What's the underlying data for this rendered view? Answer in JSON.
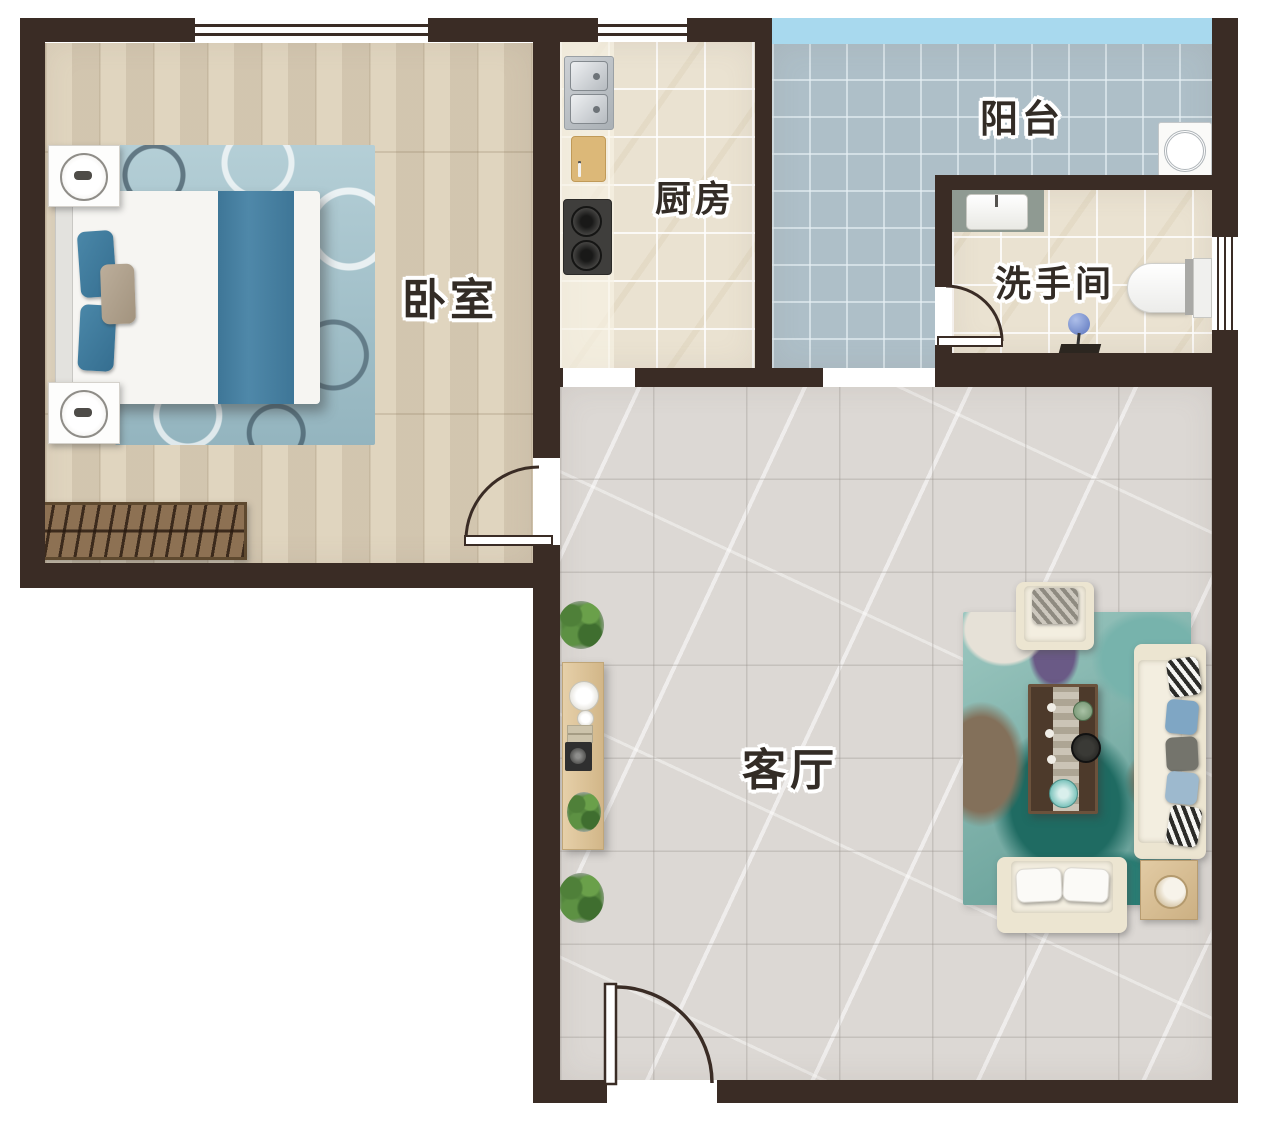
{
  "floorplan": {
    "type": "apartment-floor-plan",
    "rooms": [
      {
        "id": "bedroom",
        "label": "卧室"
      },
      {
        "id": "kitchen",
        "label": "厨房"
      },
      {
        "id": "balcony",
        "label": "阳台"
      },
      {
        "id": "bathroom",
        "label": "洗手间"
      },
      {
        "id": "living_room",
        "label": "客厅"
      }
    ],
    "colors": {
      "wall": "#3a2c25",
      "glass": "#a8d9ee",
      "bedroom_floor": "#ddd0b8",
      "kitchen_floor": "#eae2d1",
      "balcony_floor": "#aebfc8",
      "bathroom_floor": "#eae2d1",
      "living_floor": "#dcd8d4",
      "bedroom_rug": "#a7c6cf",
      "living_rug": "#8fbcb4",
      "bed_accent": "#44799c",
      "sofa_cream": "#ece5d1",
      "wood_light": "#d9c19a",
      "wood_dark": "#8d7153",
      "table_dark": "#4d3a2b",
      "label": "#332c26"
    }
  }
}
